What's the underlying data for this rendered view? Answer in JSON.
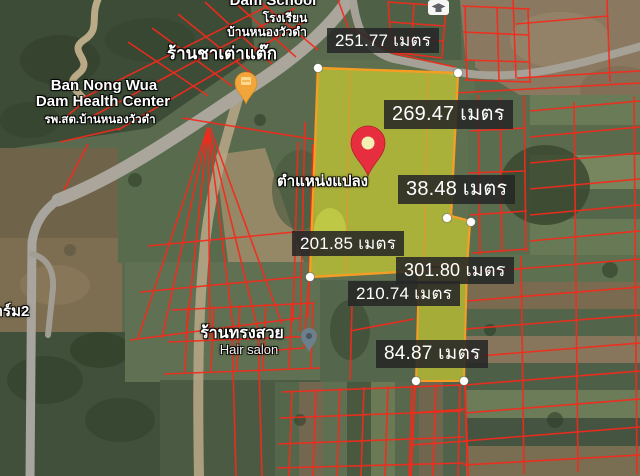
{
  "colors": {
    "parcel_line": "#f5291b",
    "highlight_fill": "rgba(232,232,42,0.55)",
    "highlight_stroke": "#f59e23",
    "label_bg": "rgba(38,38,38,0.87)",
    "label_text": "#ffffff",
    "place_label_text": "#ffffff",
    "pin_red": "#e62e3e",
    "pin_orange": "#f2a53a",
    "pin_salon": "#6b7f8c",
    "vertex_dot": "#ffffff"
  },
  "measurements": [
    {
      "label": "251.77 เมตร"
    },
    {
      "label": "269.47 เมตร"
    },
    {
      "label": "38.48 เมตร"
    },
    {
      "label": "201.85 เมตร"
    },
    {
      "label": "301.80 เมตร"
    },
    {
      "label": "210.74 เมตร"
    },
    {
      "label": "84.87 เมตร"
    }
  ],
  "places": {
    "school_name_en": "Dam School",
    "school_th_line1": "โรงเรียน",
    "school_th_line2": "บ้านหนองวัวดำ",
    "tea_shop": "ร้านชาเต่าแต๊ก",
    "health_center_en_line1": "Ban Nong Wua",
    "health_center_en_line2": "Dam Health Center",
    "health_center_th": "รพ.สต.บ้านหนองวัวดำ",
    "hair_salon_th": "ร้านทรงสวย",
    "hair_salon_en": "Hair salon",
    "farm": "ฟาร์ม2",
    "parcel_position_label": "ตำแหน่งแปลง"
  }
}
